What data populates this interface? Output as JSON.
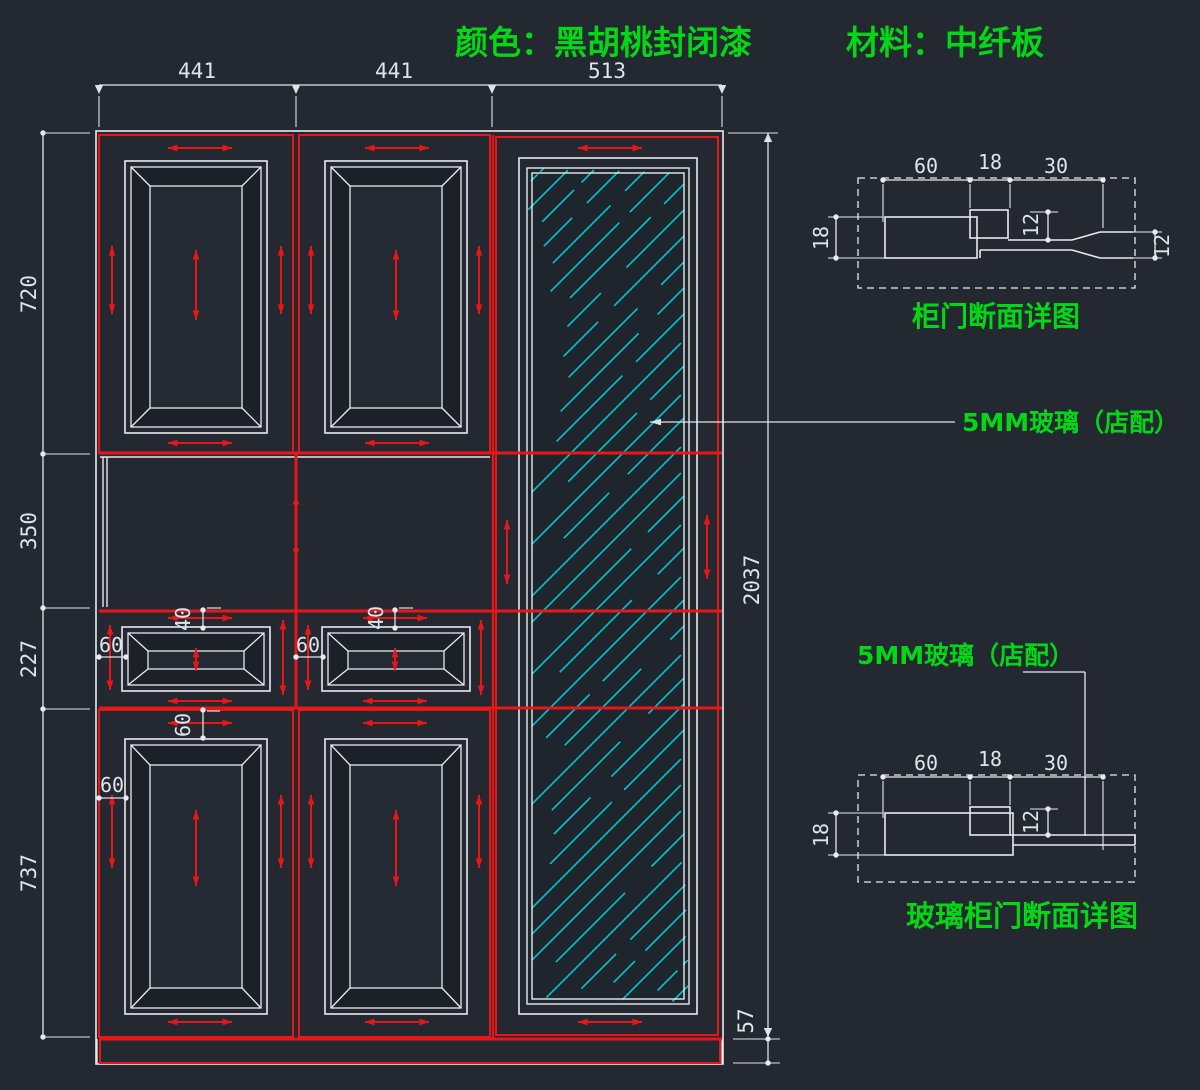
{
  "header": {
    "color_spec": "颜色：黑胡桃封闭漆",
    "material_spec": "材料：中纤板"
  },
  "dimensions": {
    "top_widths": [
      "441",
      "441",
      "513"
    ],
    "left_heights": [
      "720",
      "350",
      "227",
      "737"
    ],
    "total_height": "2037",
    "plinth_height": "57",
    "drawer_top_rail": "40",
    "drawer_stile": "60",
    "bottom_door_top_rail": "60",
    "bottom_door_stile": "60"
  },
  "annotations": {
    "glass_note": "5MM玻璃（店配）"
  },
  "detail_door": {
    "title": "柜门断面详图",
    "width_dims": [
      "60",
      "18",
      "30"
    ],
    "thickness": "18",
    "groove_depth": "12",
    "edge_thickness": "12"
  },
  "detail_glass_door": {
    "title": "玻璃柜门断面详图",
    "width_dims": [
      "60",
      "18",
      "30"
    ],
    "thickness": "18",
    "groove_depth": "12"
  },
  "colors": {
    "background": "#232831",
    "line_red": "#e81717",
    "line_white": "#e7eaee",
    "glass_cyan": "#00c6ce",
    "text_green": "#00d816",
    "dim_text": "#dfe4ea"
  }
}
